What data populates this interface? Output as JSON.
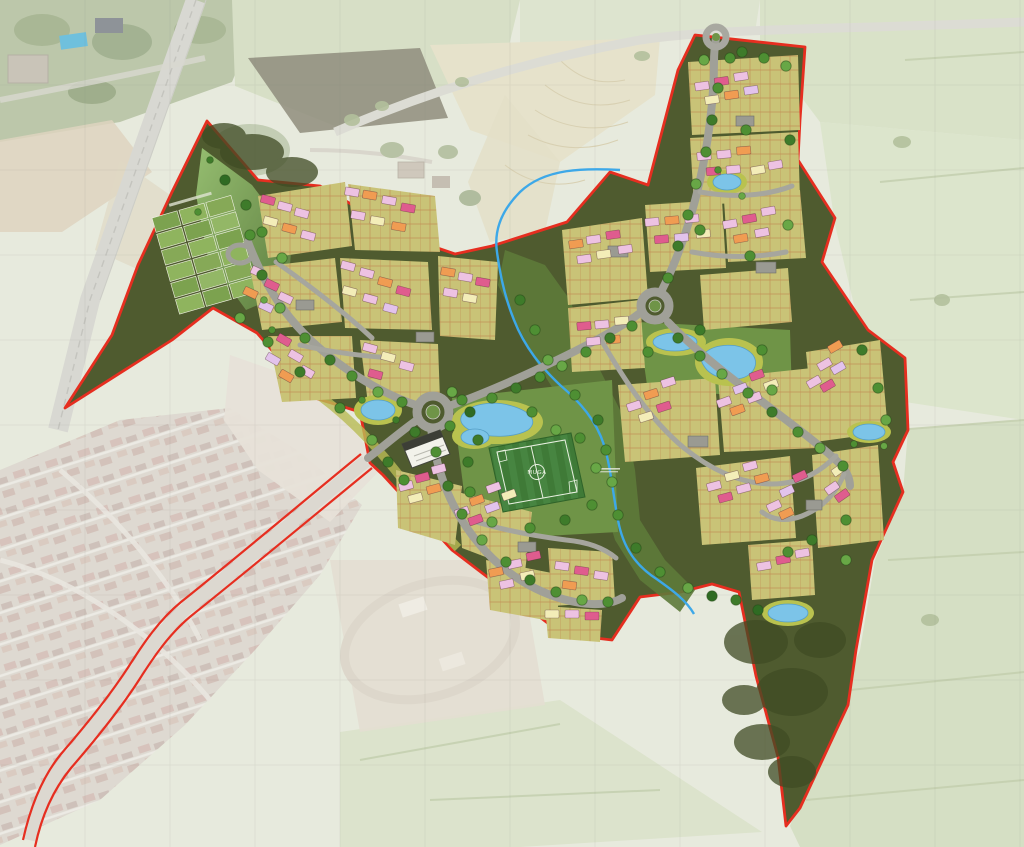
{
  "map": {
    "kind": "residential-development-masterplan-over-aerial-photograph",
    "labels": {
      "pitch": "MUGA"
    },
    "colors": {
      "application_boundary_red": "#e62e20",
      "site_open_space_dark_olive": "#4f5b2f",
      "woodland_dark": "#414d26",
      "meadow_green": "#8fb96b",
      "development_parcel_khaki": "#c9c377",
      "road_grey": "#a0a098",
      "pond_water_blue": "#7cc4e8",
      "pond_margin_yellow_green": "#b9c24f",
      "stream_blue": "#3da8e8",
      "sports_pitch_green": "#3f7a37",
      "house_pink": "#edc2e2",
      "house_magenta": "#df5c8e",
      "house_orange": "#f09c52",
      "house_cream": "#f3edb8",
      "tree_green": "#4e8f33",
      "aerial_base": "#e7eadd",
      "aerial_estate_roof": "#d6c1ba"
    }
  }
}
